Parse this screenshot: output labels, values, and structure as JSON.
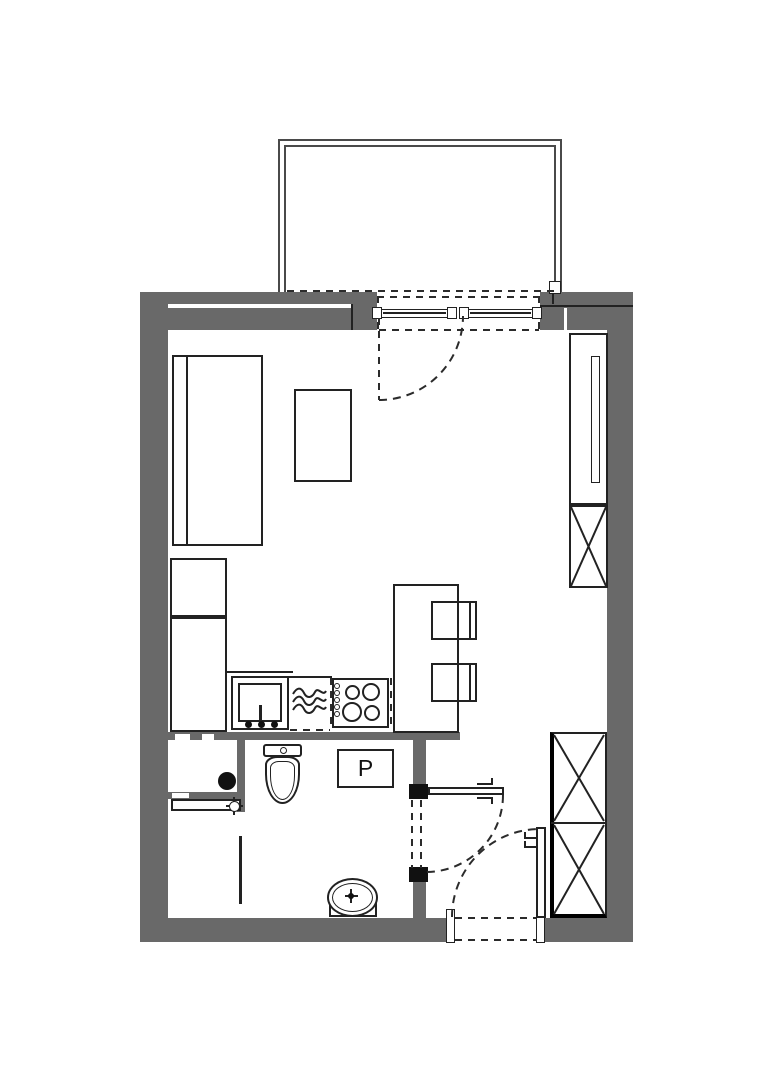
{
  "meta": {
    "type": "architectural-floor-plan",
    "description": "Top-down floor plan of a studio apartment with balcony, living/kitchen area, bathroom and entry hall"
  },
  "labels": {
    "washing_machine": "P"
  },
  "colors": {
    "background": "#ffffff",
    "wall_fill": "#696969",
    "outline": "#222222",
    "dashed_line": "#2b2b2b",
    "door_post": "#111111",
    "balcony_line": "#4a4a4a"
  },
  "inventory": {
    "balcony": "open balcony with double-line railing",
    "balcony_window": "two-panel balcony window/door with swing arc",
    "bed": "bed with headboard line",
    "coffee_table": "small rectangular table",
    "kitchen_cabinets": "tall cabinet column",
    "kitchen_sink": "sink with faucet and three knobs",
    "dishwasher": "appliance marked with wave symbol, dashed edges",
    "stove": "4-burner hob with 5 control knobs",
    "dining_table": "table with two chairs",
    "wardrobe_top": "tall wardrobe with X-crossed lower cell",
    "wardrobe_bottom": "double X-crossed wardrobe at entry",
    "toilet": "toilet with tank and flush button",
    "washing_machine_box": "square box labelled P",
    "floor_drain": "black circular drain",
    "shower": "shower area with valve crosshair and glass screen",
    "washbasin": "oval basin on vanity",
    "bathroom_door": "swing door with dashed closed position",
    "entrance_door": "entry door with swing arc and threshold"
  }
}
